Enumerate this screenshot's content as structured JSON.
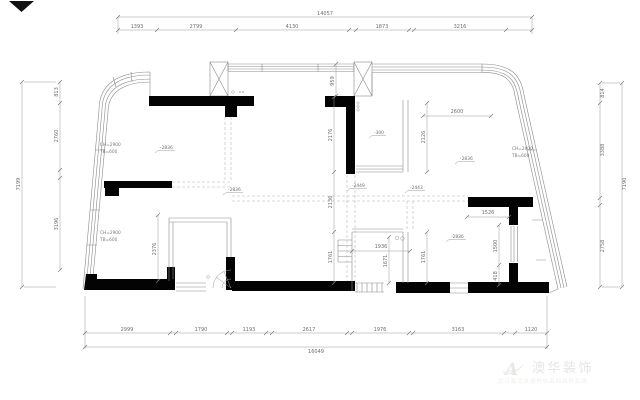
{
  "plan": {
    "dim_top": {
      "overall": "14057",
      "segments": [
        "1393",
        "2799",
        "4130",
        "1873",
        "3216"
      ]
    },
    "dim_bottom": {
      "overall": "16049",
      "segments": [
        "2999",
        "1790",
        "1193",
        "2617",
        "1976",
        "3163",
        "1120"
      ]
    },
    "dim_left": {
      "overall": "7199",
      "segments": [
        "813",
        "2760",
        "3196"
      ]
    },
    "dim_right": {
      "overall": "7190",
      "segments": [
        "814",
        "3388",
        "2758"
      ]
    },
    "dim_inner": {
      "d959": "959",
      "d2600": "2600",
      "d2126": "2126",
      "d2176": "2176",
      "d2136": "2136",
      "d1761a": "1761",
      "d1761b": "1761",
      "d1671": "1671",
      "d1936": "1936",
      "d1526": "1526",
      "d1500": "1500",
      "d418": "418",
      "d2376": "2376"
    },
    "levels": {
      "l1": "-2836",
      "l2": "-2836",
      "l3": "-300",
      "l4": "-2449",
      "l5": "-2443",
      "l6": "-2836",
      "l7": "-2836"
    },
    "notes": {
      "ch": "CH=2900",
      "tb": "TB=600"
    },
    "watermark": {
      "logo": "A",
      "brand": "澳华装饰",
      "tagline": "武汉最受欢迎的中高档装饰品牌"
    }
  }
}
